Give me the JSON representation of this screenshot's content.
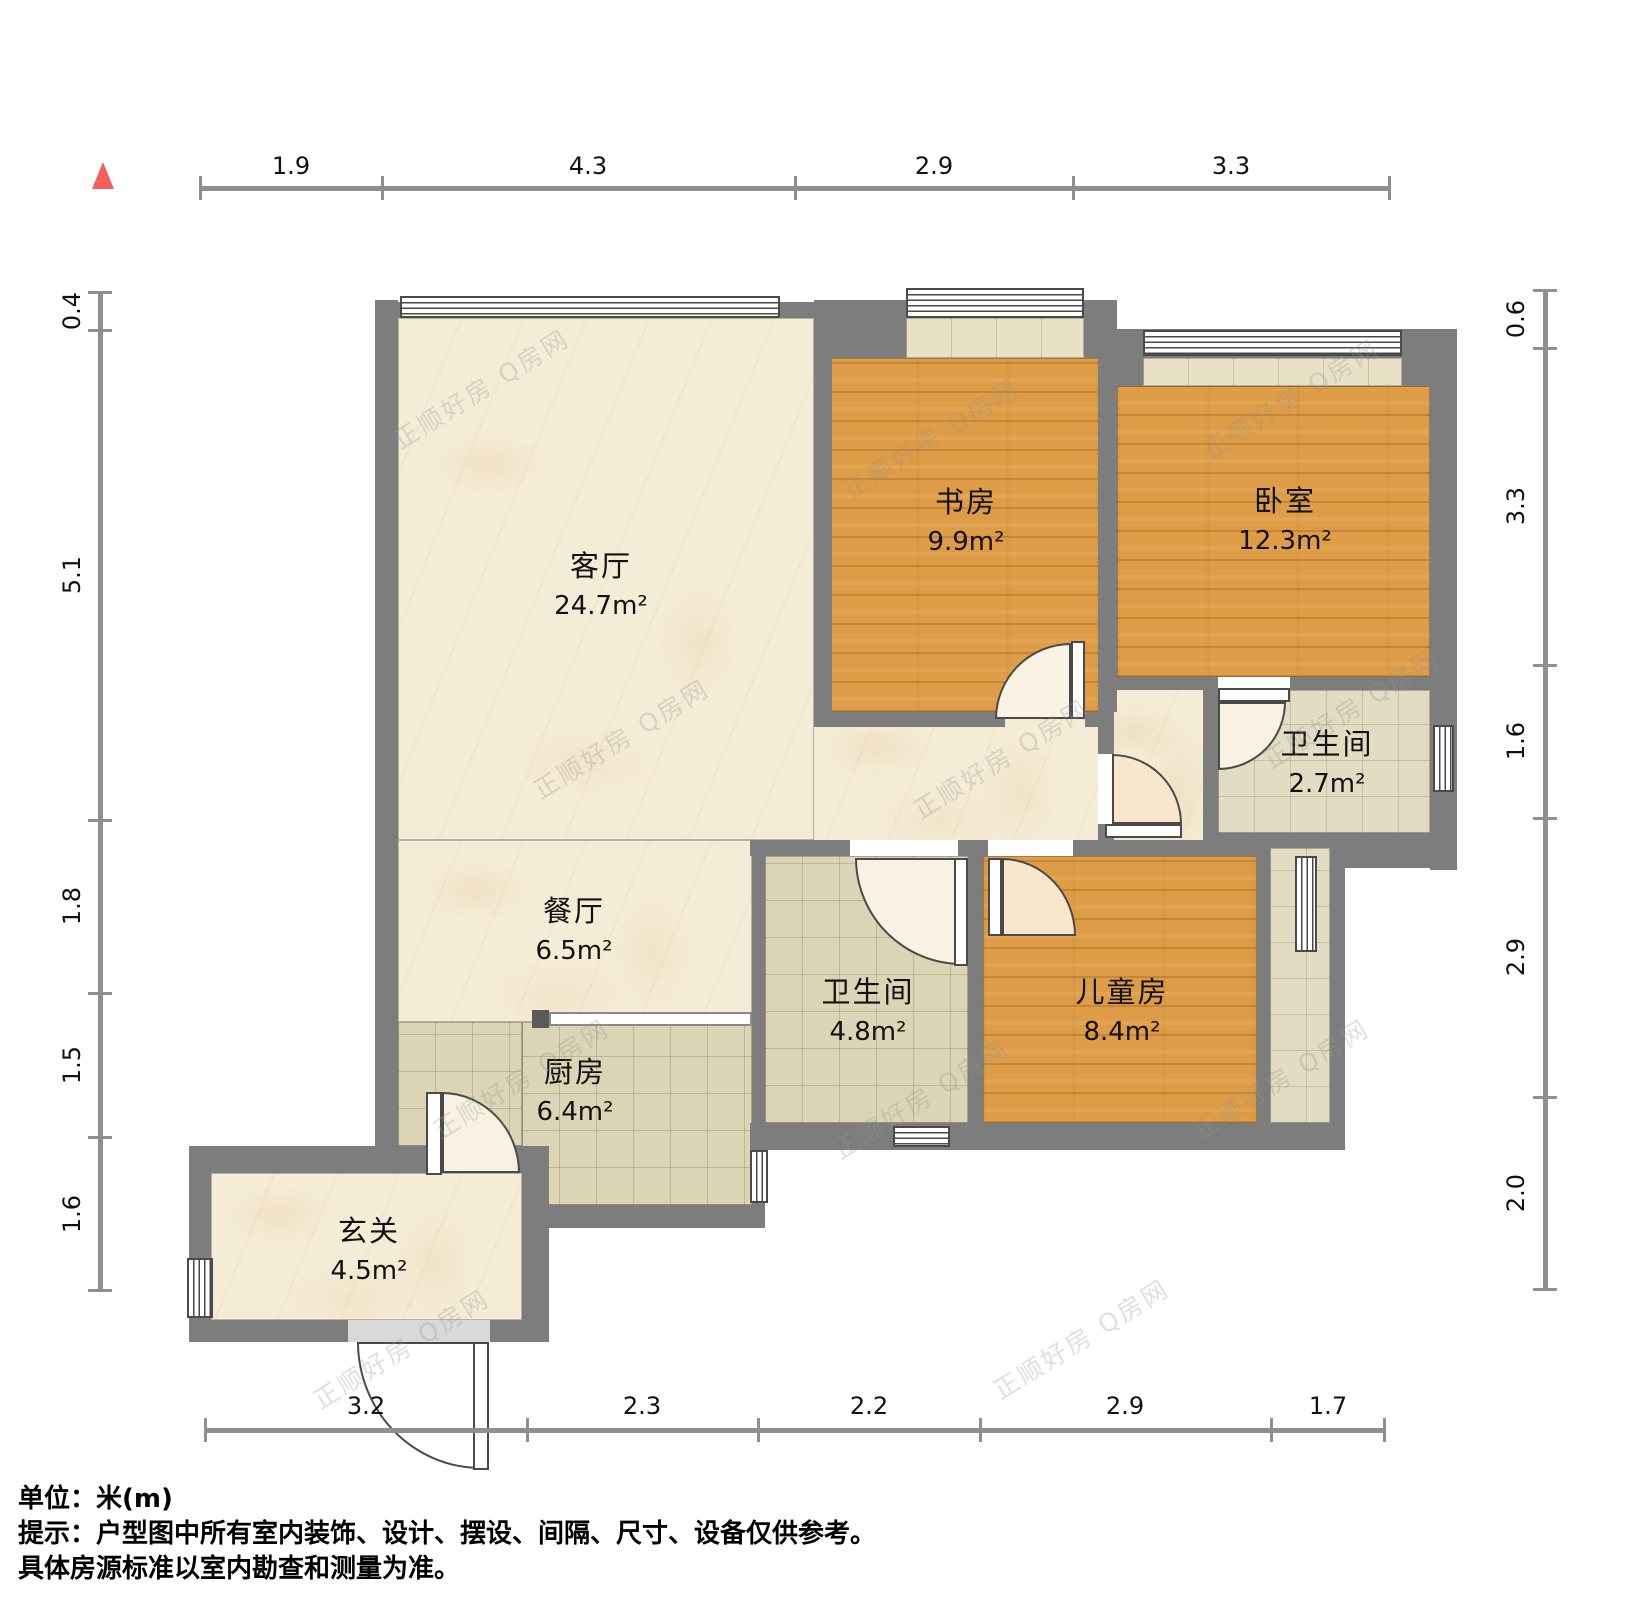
{
  "watermark": {
    "text": "正顺好房 Q房网"
  },
  "rooms": {
    "living": {
      "name": "客厅",
      "area": "24.7m²"
    },
    "dining": {
      "name": "餐厅",
      "area": "6.5m²"
    },
    "kitchen": {
      "name": "厨房",
      "area": "6.4m²"
    },
    "entry": {
      "name": "玄关",
      "area": "4.5m²"
    },
    "study": {
      "name": "书房",
      "area": "9.9m²"
    },
    "bedroom": {
      "name": "卧室",
      "area": "12.3m²"
    },
    "bath_small": {
      "name": "卫生间",
      "area": "2.7m²"
    },
    "bath_main": {
      "name": "卫生间",
      "area": "4.8m²"
    },
    "kids": {
      "name": "儿童房",
      "area": "8.4m²"
    }
  },
  "dimensions": {
    "top": [
      "1.9",
      "4.3",
      "2.9",
      "3.3"
    ],
    "bottom": [
      "3.2",
      "2.3",
      "2.2",
      "2.9",
      "1.7"
    ],
    "left": [
      "0.4",
      "5.1",
      "1.8",
      "1.5",
      "1.6"
    ],
    "right": [
      "0.6",
      "3.3",
      "1.6",
      "2.9",
      "2.0"
    ]
  },
  "footer": {
    "line1": "单位：米(m)",
    "line2": "提示：户型图中所有室内装饰、设计、摆设、间隔、尺寸、设备仅供参考。",
    "line3": "具体房源标准以室内勘查和测量为准。"
  }
}
